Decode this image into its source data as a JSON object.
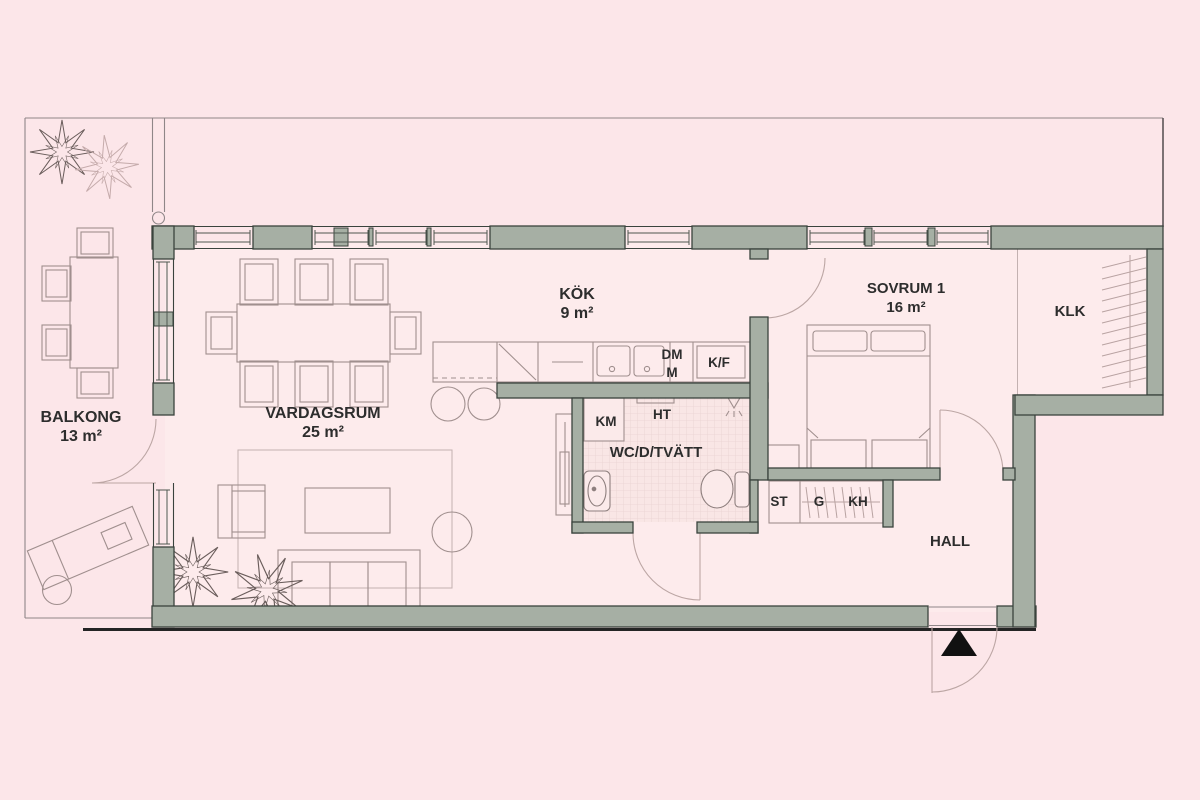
{
  "colors": {
    "background": "#fce6e9",
    "floor": "#fdebec",
    "wall_fill": "#a6afa4",
    "wall_outline": "#3a433d",
    "furniture_line": "#a08f8e",
    "plan_line": "#8f8688",
    "label_text": "#2d2d2d",
    "entrance_marker": "#111111"
  },
  "rooms": {
    "balcony": {
      "name": "BALKONG",
      "area": "13 m²"
    },
    "living_room": {
      "name": "VARDAGSRUM",
      "area": "25 m²"
    },
    "kitchen": {
      "name": "KÖK",
      "area": "9 m²"
    },
    "bathroom": {
      "name": "WC/D/TVÄTT"
    },
    "bedroom": {
      "name": "SOVRUM 1",
      "area": "16 m²"
    },
    "walk_in_closet": {
      "name": "KLK"
    },
    "hall": {
      "name": "HALL"
    }
  },
  "appliances": {
    "dishwasher": "DM",
    "microwave": "M",
    "fridge_freezer": "K/F",
    "washing_machine": "KM",
    "towel_dryer": "HT",
    "storage": "ST",
    "wardrobe": "G",
    "hat_shelf": "KH"
  }
}
